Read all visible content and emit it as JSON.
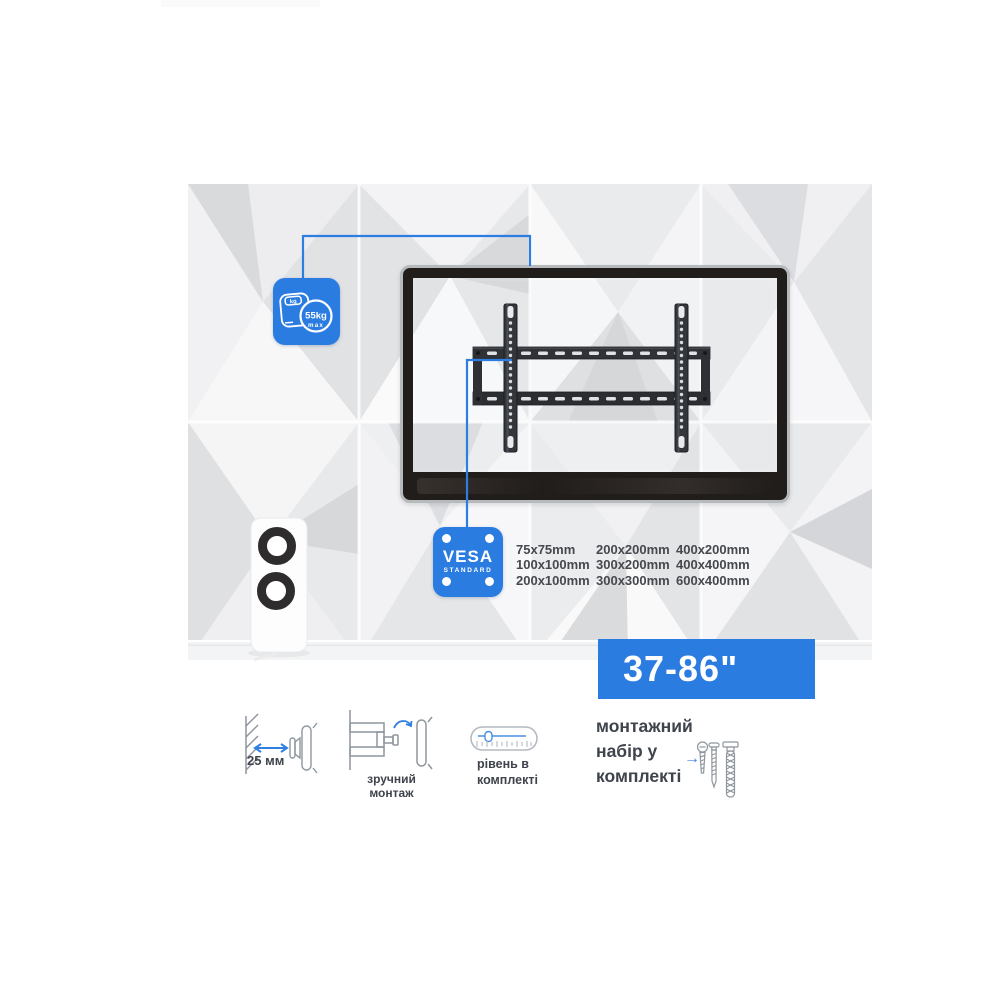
{
  "banner": {
    "size_range": "37-86\""
  },
  "badges": {
    "weight": {
      "unit": "kg",
      "value": "55kg",
      "max_label": "max"
    },
    "vesa": {
      "title": "VESA",
      "subtitle": "STANDARD"
    }
  },
  "vesa_sizes": {
    "columns": [
      [
        "75x75mm",
        "100x100mm",
        "200x100mm"
      ],
      [
        "200x200mm",
        "300x200mm",
        "300x300mm"
      ],
      [
        "400x200mm",
        "400x400mm",
        "600x400mm"
      ]
    ]
  },
  "features": {
    "wall_distance": {
      "label": "25 мм",
      "icon": "wall-distance-icon"
    },
    "easy_mount": {
      "label": "зручний монтаж",
      "icon": "swivel-bracket-icon"
    },
    "level": {
      "label_lines": [
        "рівень в",
        "комплекті"
      ],
      "icon": "spirit-level-icon"
    },
    "mount_kit": {
      "label_lines": [
        "монтажний",
        "набір у",
        "комплекті"
      ],
      "arrow": "→",
      "icon": "screws-icon"
    }
  },
  "colors": {
    "accent": "#2b7ce1",
    "text_dark": "#3e434c",
    "icon_gray": "#8e969e"
  }
}
